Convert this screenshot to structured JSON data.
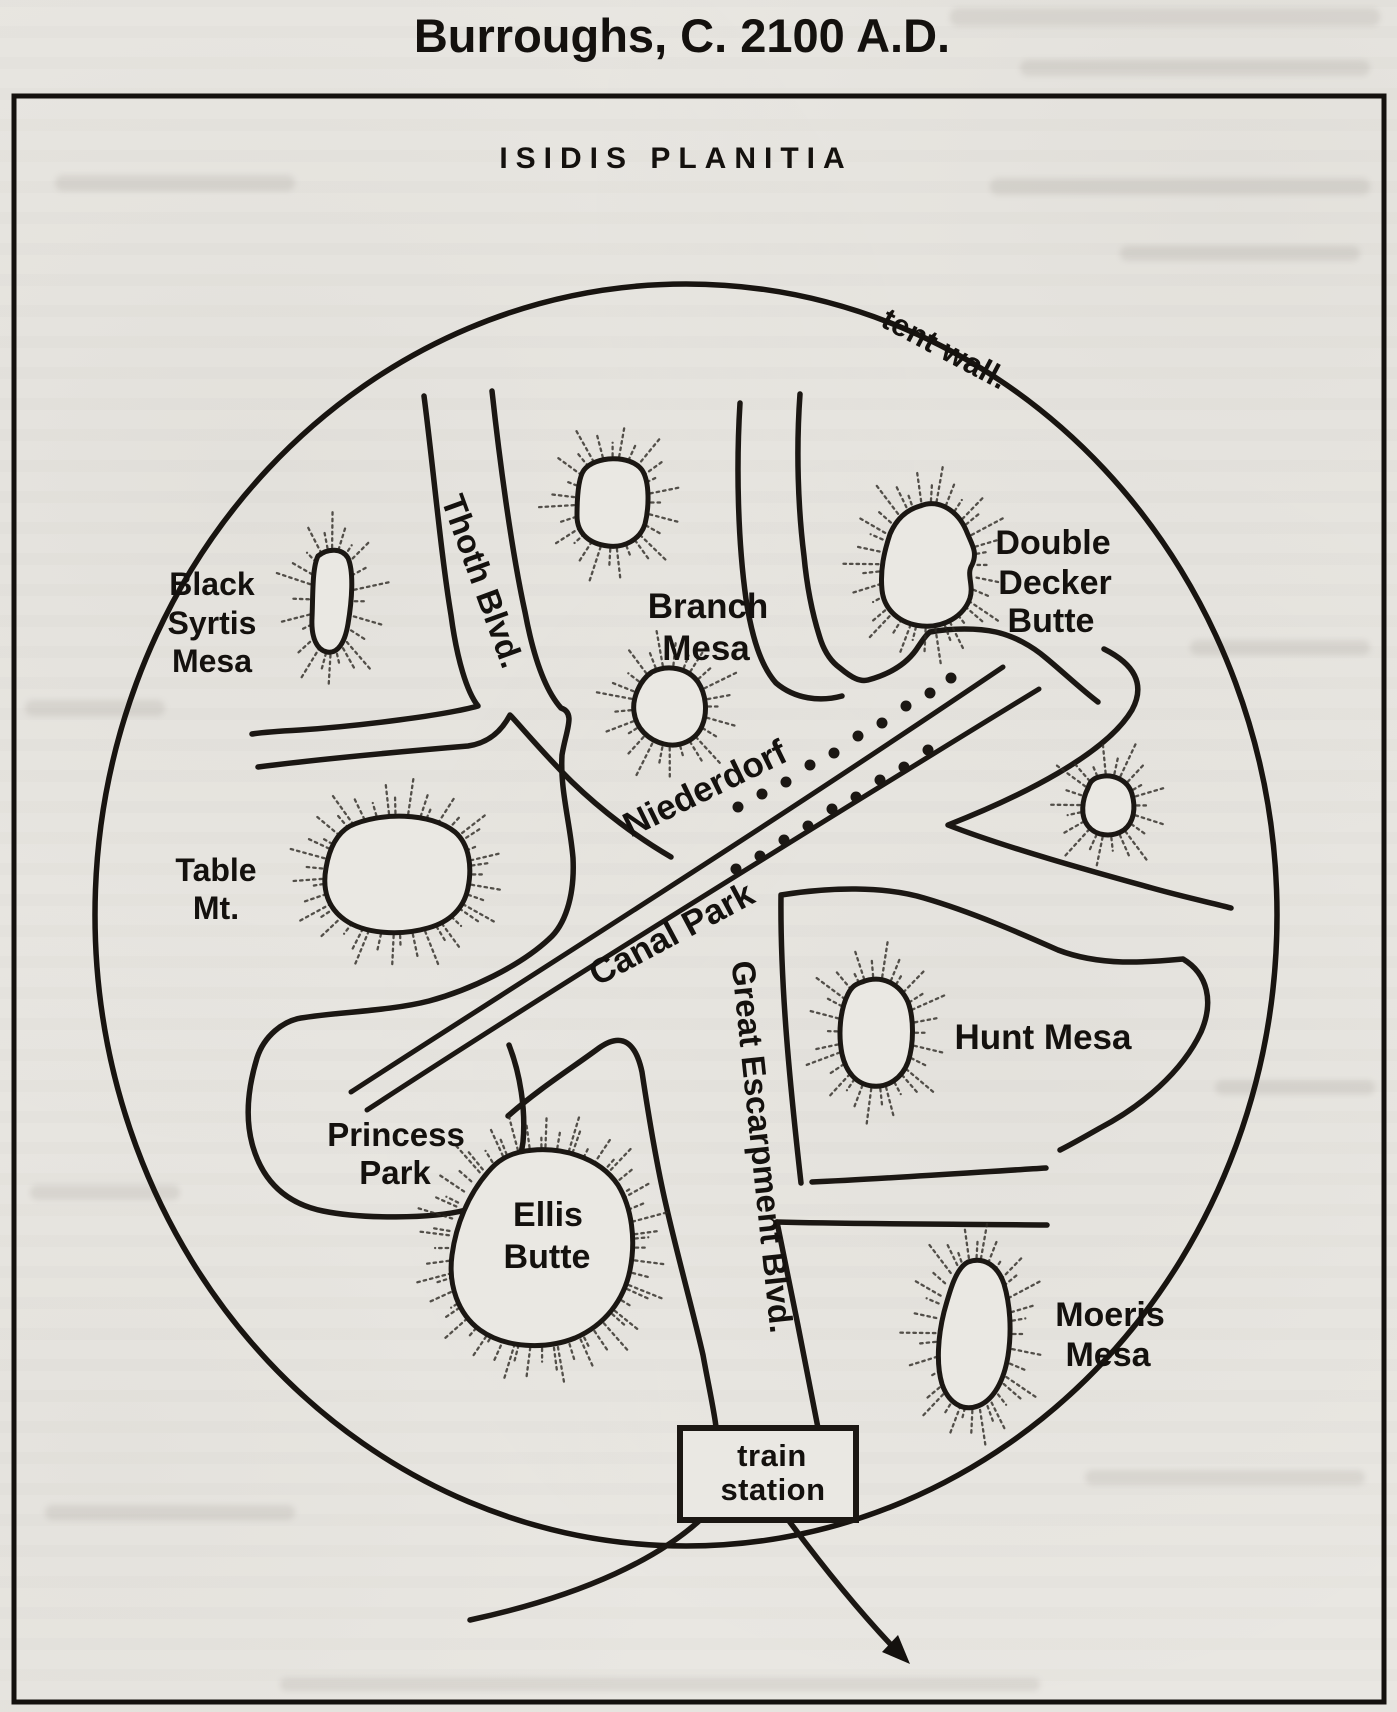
{
  "title": "Burroughs, C. 2100 A.D.",
  "region_label": "ISIDIS PLANITIA",
  "tent_wall_label": "tent wall.",
  "roads": {
    "thoth": "Thoth Blvd.",
    "great_escarpment": "Great Escarpment Blvd.",
    "niederdorf": "Niederdorf",
    "canal_park": "Canal Park"
  },
  "features": {
    "black_syrtis": {
      "lines": [
        "Black",
        "Syrtis",
        "Mesa"
      ]
    },
    "branch": {
      "lines": [
        "Branch",
        "Mesa"
      ]
    },
    "double_decker": {
      "lines": [
        "Double",
        "Decker",
        "Butte"
      ]
    },
    "table": {
      "lines": [
        "Table",
        "Mt."
      ]
    },
    "princess_park": {
      "lines": [
        "Princess",
        "Park"
      ]
    },
    "ellis": {
      "lines": [
        "Ellis",
        "Butte"
      ]
    },
    "hunt": {
      "lines": [
        "Hunt Mesa"
      ]
    },
    "moeris": {
      "lines": [
        "Moeris",
        "Mesa"
      ]
    },
    "train_station": {
      "lines": [
        "train",
        "station"
      ]
    }
  },
  "colors": {
    "ink": "#1b1713",
    "paper": "#e9e7e2"
  }
}
